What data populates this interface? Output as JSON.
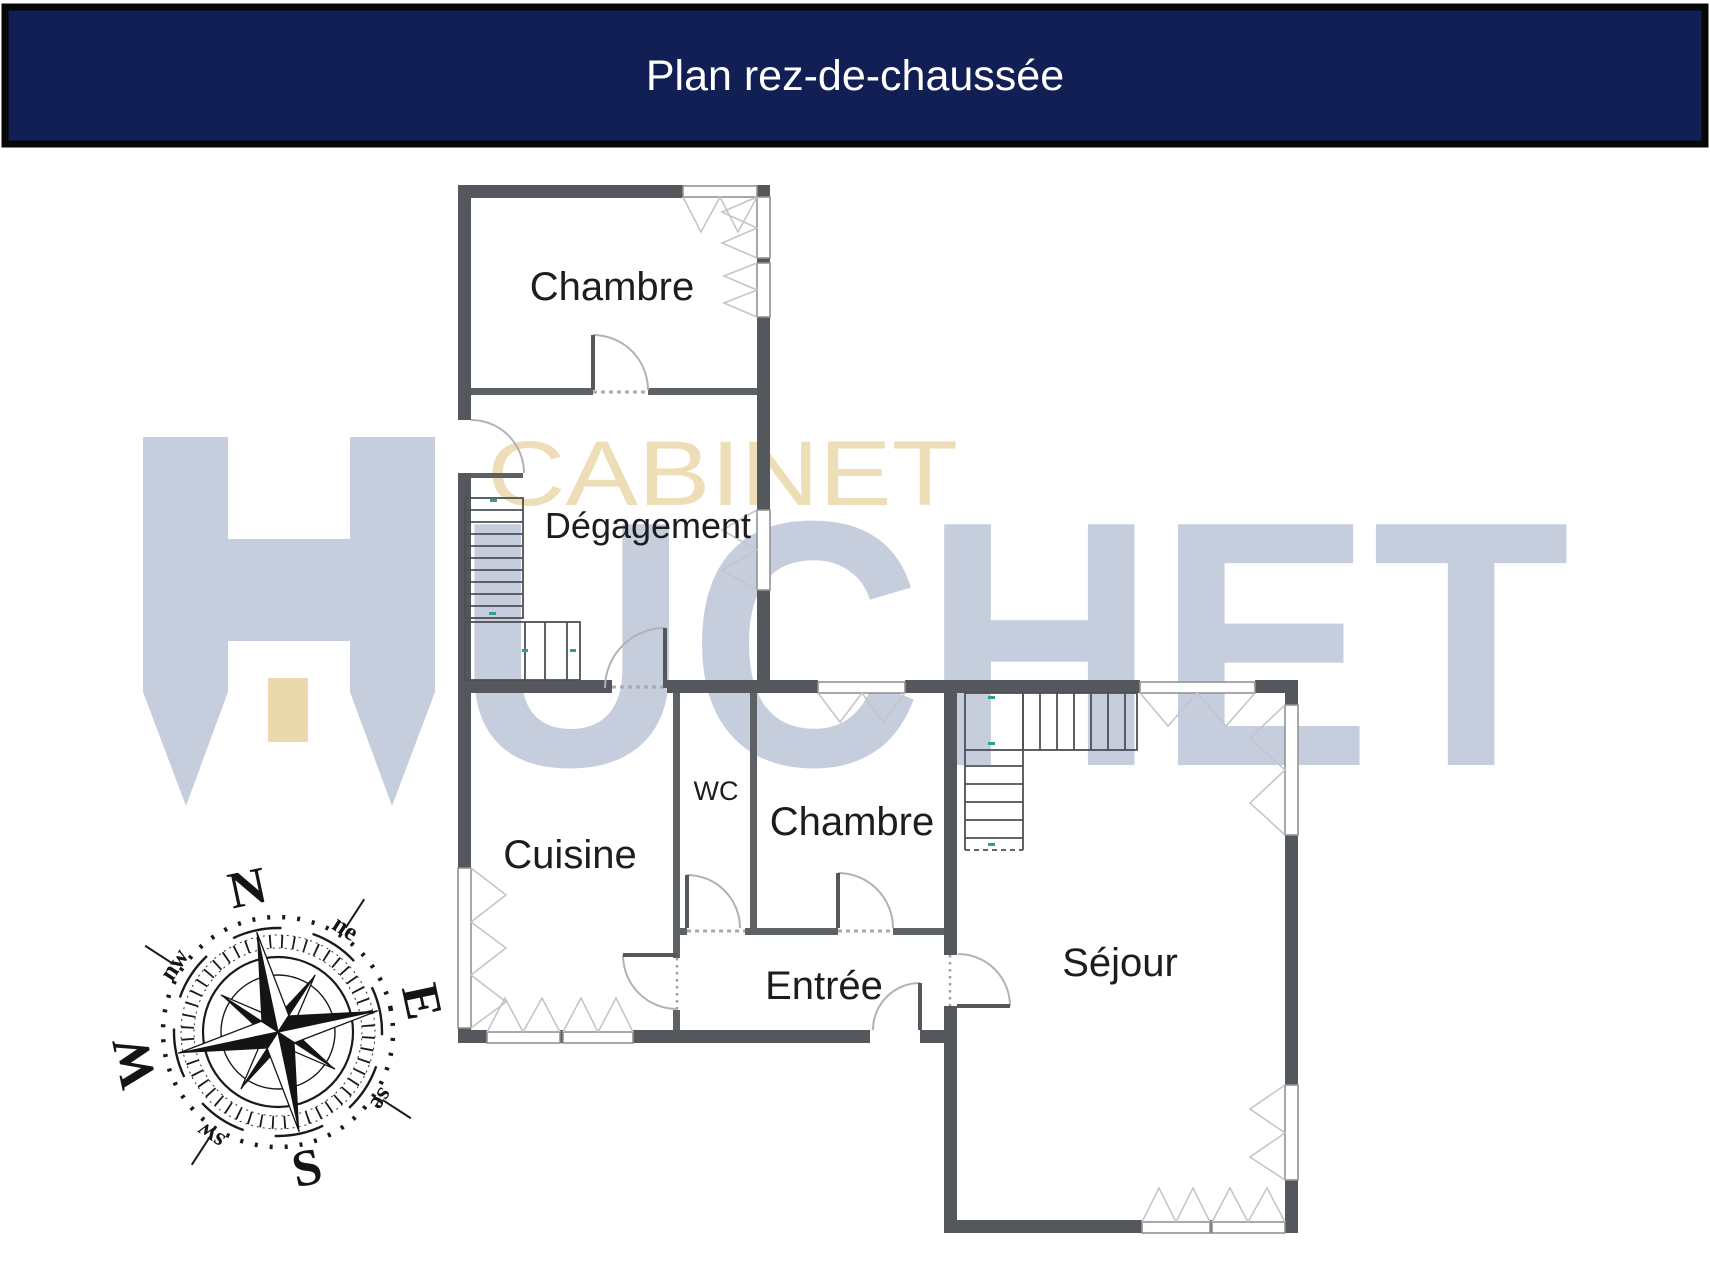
{
  "header": {
    "title": "Plan rez-de-chaussée"
  },
  "floor_plan": {
    "rooms": {
      "chambre_nord": {
        "label": "Chambre"
      },
      "degagement": {
        "label": "Dégagement"
      },
      "cuisine": {
        "label": "Cuisine"
      },
      "wc": {
        "label": "WC"
      },
      "chambre_sud": {
        "label": "Chambre"
      },
      "entree": {
        "label": "Entrée"
      },
      "sejour": {
        "label": "Séjour"
      }
    }
  },
  "watermark": {
    "top_text": "CABINET",
    "logo_letter": "H",
    "bottom_text_rest": "UCHET"
  },
  "compass": {
    "n": "N",
    "e": "E",
    "s": "S",
    "w": "W",
    "ne": "ne",
    "se": "se",
    "sw": "sw",
    "nw": "nw"
  },
  "colors": {
    "title_bar": "#121f55",
    "title_text": "#ffffff",
    "wall_dark": "#54575b",
    "wall_inner": "#5e6164",
    "watermark_blue": "#c6cede",
    "watermark_beige": "#ead9ab",
    "stair_mark_teal": "#2f9d8f"
  }
}
